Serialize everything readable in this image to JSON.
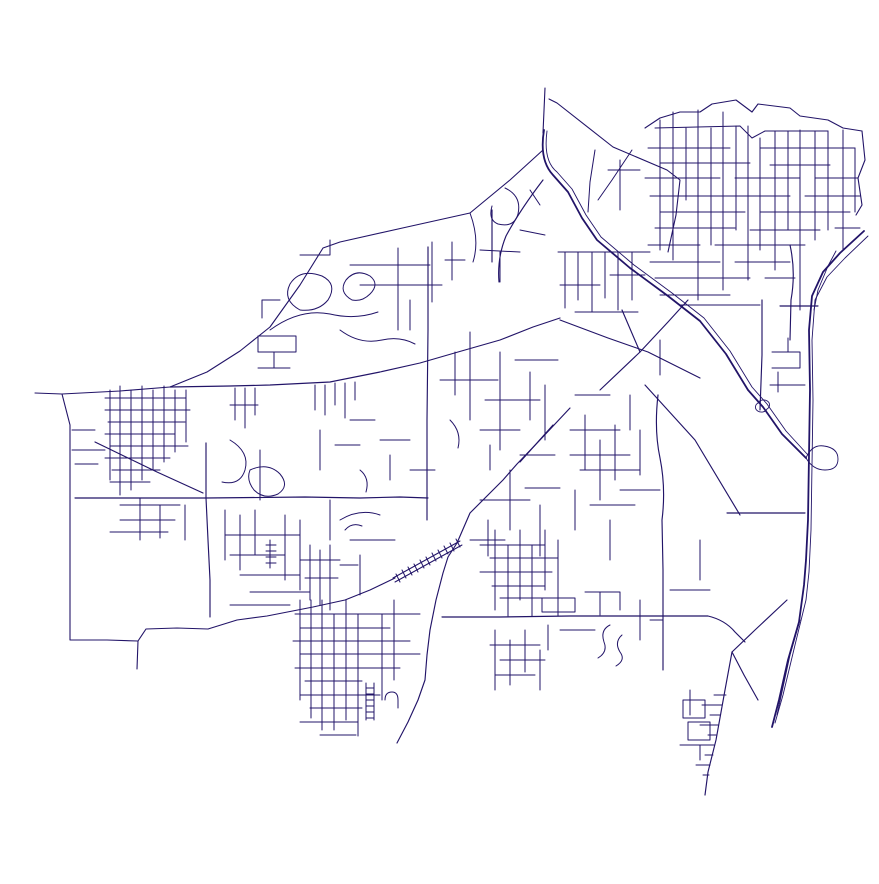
{
  "meta": {
    "description": "street-network-map",
    "background_color": "#ffffff",
    "stroke_color": "#221468",
    "canvas_width": 879,
    "canvas_height": 884
  },
  "map": {
    "stroke_color": "#221468",
    "layers": [
      {
        "name": "boundary",
        "width": 1.1,
        "paths": [
          "M545,88 L543,133",
          "M543,150 L510,180 L470,213 L407,227 L340,242 L323,248 L300,285 L270,327 L240,351 L207,372 L170,387 L120,391 L62,394 L35,393",
          "M62,394 L70,425 L70,555 L70,640 L107,640 L138,641 L146,629 L177,628 L208,629 L237,620 L267,616 L313,607 L345,600 L370,590 L395,578",
          "M138,641 L137,669",
          "M549,99 L557,103 L613,147 L667,170 L680,180 L676,215 L668,252",
          "M645,128 L660,118 L680,112 L700,112 L712,104 L736,100 L752,112 L758,104 L790,108 L800,116 L828,120 L843,128 L862,131",
          "M862,131 L865,160 L858,178 L862,205 L856,215"
        ]
      },
      {
        "name": "highway",
        "width": 1.8,
        "paths": [
          "M544,130 Q539,160 553,175 L568,192 L582,218 L597,240 L630,268 L668,296 L700,321 L726,354 L748,390 L763,407 L782,434 L806,458",
          "M864,231 L840,253 L823,272 L812,296 L809,330 L810,390 L809,455 L808,520 L806,560 L804,585 L799,622 L788,660 L779,700 L772,727"
        ]
      },
      {
        "name": "highway-strands",
        "width": 0.9,
        "paths": [
          "M547,131 Q543,161 557,172 L572,189 L586,215 L601,237 L634,265 L672,293 L704,318 L730,351 L752,387 L767,404 L786,431 L808,455",
          "M868,236 L845,258 L827,277 L815,300 L812,340 L813,400 L812,465 L811,530 L809,572 L806,600 L795,645 L783,695 L775,723",
          "M836,251 L828,266 L818,290 L814,310",
          "M800,620 L790,655 L777,715",
          "M758,403 a6,5 0 1 1 9,6 a6,5 0 1 1 -9,-6",
          "M806,458 q6,-14 18,-12 q14,2 14,13 q0,11 -13,11 q-12,0 -19,-12"
        ]
      },
      {
        "name": "arterial",
        "width": 1.15,
        "paths": [
          "M170,387 L230,386 L270,385 L330,382 L380,372 L420,363 L458,352 L500,340 L533,327 L560,318",
          "M75,498 L150,498 L206,498 L305,497 L360,498 L400,497 L428,498",
          "M428,247 L428,330 L427,420 L427,498 L427,520",
          "M570,408 L540,440 L517,464 L503,480 L470,513 L457,543 L448,557 L443,573 L436,600 L430,630 L427,655 L425,680 L418,700 L408,722 L397,743",
          "M206,443 L206,498 L208,540 L210,580 L210,617",
          "M442,617 L500,617 L570,616 L650,616 L708,616 Q725,620 735,632 L745,642",
          "M95,442 L157,472 L203,493",
          "M560,320 L608,338 L648,352 L700,378",
          "M600,390 L640,352 L668,322 L688,300",
          "M640,352 L622,310",
          "M645,385 L695,440 L740,515",
          "M727,513 L805,513",
          "M658,395 Q654,430 660,458 Q666,488 662,520 L663,570 L663,617 L663,670",
          "M762,300 L762,355 L760,410",
          "M787,600 L755,630 L732,652 L744,675 L758,700",
          "M732,652 L725,690 L716,740 L708,772 L705,795",
          "M492,210 L492,262",
          "M543,180 Q520,210 506,236 Q497,258 499,282",
          "M790,245 Q796,272 791,300 L790,340",
          "M780,306 L818,306",
          "M553,425 L520,462"
        ]
      },
      {
        "name": "railroad",
        "width": 1.0,
        "paths": [
          "M393,578 L460,541",
          "M395,582 L462,545",
          "M396,574 L400,582",
          "M402,570 L406,578",
          "M408,567 L412,575",
          "M414,564 L418,572",
          "M420,560 L424,568",
          "M426,557 L430,565",
          "M432,553 L436,561",
          "M438,550 L442,558",
          "M444,546 L448,554",
          "M450,543 L454,551",
          "M456,539 L460,547"
        ]
      },
      {
        "name": "streets",
        "width": 1.0,
        "paths": [
          "M655,128 L740,126 L752,138 L765,131 L828,131",
          "M648,148 L730,148",
          "M760,148 L855,148",
          "M660,163 L750,163",
          "M770,165 L830,165",
          "M645,178 L720,178",
          "M735,178 L800,178",
          "M815,178 L858,178",
          "M650,196 L790,196",
          "M805,196 L860,196",
          "M660,212 L745,212",
          "M760,212 L850,212",
          "M655,228 L735,228",
          "M750,230 L820,230",
          "M835,228 L860,228",
          "M648,245 L700,245",
          "M715,245 L805,245",
          "M650,262 L720,262",
          "M735,262 L790,262",
          "M655,278 L750,278",
          "M765,278 L795,278",
          "M660,295 L730,295",
          "M680,305 L760,305",
          "M660,120 L660,250",
          "M673,112 L673,260",
          "M686,128 L686,200",
          "M698,110 L698,300",
          "M711,128 L711,245",
          "M723,112 L723,290",
          "M736,126 L736,230",
          "M748,126 L748,280",
          "M760,138 L760,250",
          "M775,131 L775,270",
          "M788,131 L788,230",
          "M800,130 L800,310",
          "M815,131 L815,240",
          "M828,131 L828,230",
          "M843,130 L843,250",
          "M855,148 L855,212",
          "M558,252 L650,252",
          "M565,252 L565,308",
          "M578,252 L578,300",
          "M592,252 L592,312",
          "M605,252 L605,298",
          "M618,252 L618,310",
          "M632,252 L632,300",
          "M560,285 L600,285",
          "M610,275 L645,275",
          "M575,312 L638,312",
          "M595,150 L590,182 L588,212",
          "M632,150 L612,180 L598,200",
          "M620,160 L620,210",
          "M608,170 L640,170",
          "M470,213 Q480,240 473,262",
          "M505,188 Q522,196 518,214 Q514,228 498,224 Q488,220 492,206",
          "M530,190 L540,205",
          "M480,250 L520,252",
          "M500,252 L500,282",
          "M520,230 L545,235",
          "M398,248 L398,330",
          "M432,242 L432,302",
          "M350,265 L430,265",
          "M360,285 L442,285",
          "M300,310 Q282,300 290,284 Q300,268 322,276 Q338,284 328,300 Q318,312 300,310 Z",
          "M352,300 Q338,292 346,280 Q356,268 370,276 Q380,284 370,294 Q362,302 352,300 Z",
          "M270,330 Q300,308 330,314 Q355,320 378,312",
          "M410,300 L410,330",
          "M445,260 L465,260",
          "M452,242 L452,280",
          "M300,255 L330,255 L330,240",
          "M280,300 L262,300 L262,318",
          "M258,352 L296,352 L296,336 L258,336 Z",
          "M258,368 L290,368",
          "M274,368 L274,352",
          "M340,330 Q360,345 382,340 Q400,336 415,344",
          "M470,332 L470,420",
          "M500,352 L500,450",
          "M455,352 L455,395",
          "M440,380 L498,380",
          "M485,400 L540,400",
          "M515,360 L558,360",
          "M530,372 L530,420",
          "M545,385 L545,440",
          "M450,420 Q462,432 458,448",
          "M480,430 L520,430",
          "M490,445 L490,470",
          "M520,455 L555,455",
          "M480,500 L530,500",
          "M510,470 L510,530",
          "M525,488 L560,488",
          "M540,505 L540,556",
          "M470,540 L505,540",
          "M488,520 L488,556",
          "M495,530 L495,610",
          "M508,545 L508,616",
          "M520,530 L520,600",
          "M532,545 L532,616",
          "M545,530 L545,590",
          "M558,540 L558,616",
          "M480,545 L545,545",
          "M490,558 L558,558",
          "M480,572 L552,572",
          "M492,586 L545,586",
          "M500,598 L560,598",
          "M495,630 L495,690",
          "M510,640 L510,685",
          "M525,630 L525,672",
          "M540,650 L540,690",
          "M490,645 L540,645",
          "M500,660 L545,660",
          "M495,675 L535,675",
          "M300,600 L300,700",
          "M311,600 L311,718",
          "M322,600 L322,730",
          "M334,614 L334,730",
          "M346,600 L346,720",
          "M358,614 L358,736",
          "M382,614 L382,700",
          "M394,600 L394,680",
          "M295,614 L420,614",
          "M300,628 L390,628",
          "M293,641 L410,641",
          "M300,654 L420,654",
          "M295,668 L400,668",
          "M305,681 L362,681",
          "M300,695 L380,695",
          "M310,708 L362,708",
          "M300,722 L358,722",
          "M320,735 L356,735",
          "M366,683 L366,720",
          "M374,683 L374,720",
          "M366,688 L374,688",
          "M366,694 L374,694",
          "M366,700 L374,700",
          "M366,706 L374,706",
          "M366,712 L374,712",
          "M366,718 L374,718",
          "M385,700 Q385,692 392,692 Q398,692 398,700 L398,708",
          "M110,390 L110,480",
          "M120,386 L120,495",
          "M131,390 L131,490",
          "M142,386 L142,480",
          "M153,390 L153,470",
          "M164,386 L164,462",
          "M175,390 L175,452",
          "M186,390 L186,442",
          "M105,398 L186,398",
          "M105,410 L190,410",
          "M108,422 L185,422",
          "M105,434 L175,434",
          "M110,446 L188,446",
          "M105,458 L170,458",
          "M112,470 L160,470",
          "M110,482 L150,482",
          "M72,450 L105,450",
          "M75,464 L98,464",
          "M72,430 L95,430",
          "M120,505 L180,505",
          "M140,498 L140,540",
          "M160,505 L160,538",
          "M120,520 L175,520",
          "M110,532 L168,532",
          "M185,505 L185,540",
          "M230,440 Q250,452 245,470 Q240,486 222,482",
          "M260,450 L260,500",
          "M225,510 L225,560",
          "M240,515 L240,570",
          "M255,510 L255,555",
          "M270,540 L270,568",
          "M266,545 L276,545",
          "M266,551 L276,551",
          "M266,557 L276,557",
          "M266,563 L276,563",
          "M285,515 L285,580",
          "M300,520 L300,590",
          "M225,535 L300,535",
          "M230,555 L285,555",
          "M240,575 L300,575",
          "M250,592 L310,592",
          "M230,605 L290,605",
          "M250,470 Q268,462 280,474 Q290,486 278,494 Q264,500 254,490 Q246,480 250,470 Z",
          "M310,545 L310,600",
          "M320,550 L320,605",
          "M330,545 L330,610",
          "M300,560 L340,560",
          "M305,578 L338,578",
          "M340,520 Q360,508 380,515",
          "M350,540 L395,540",
          "M360,555 L360,595",
          "M340,565 L358,565",
          "M345,530 Q352,522 362,526",
          "M330,500 L330,540",
          "M570,430 L620,430",
          "M585,415 L585,470",
          "M600,440 L600,500",
          "M615,425 L615,480",
          "M570,455 L630,455",
          "M580,470 L640,470",
          "M620,490 L660,490",
          "M575,490 L575,530",
          "M590,505 L635,505",
          "M610,520 L610,560",
          "M640,430 L640,475",
          "M630,395 L630,430",
          "M575,395 L610,395",
          "M542,598 L575,598 L575,612 L542,612 Z",
          "M585,592 L620,592 L620,610",
          "M600,592 L600,615",
          "M548,625 L548,650",
          "M560,630 L595,630",
          "M610,625 Q600,630 604,642 Q608,652 598,658",
          "M622,635 Q614,642 620,652 Q626,660 616,666",
          "M640,600 L640,640",
          "M650,620 L663,620",
          "M700,540 L700,580",
          "M670,590 L710,590",
          "M714,695 L726,695",
          "M702,705 L722,705",
          "M710,715 L720,715",
          "M700,725 L718,725",
          "M708,735 L716,735",
          "M698,745 L714,745",
          "M705,755 L713,755",
          "M696,765 L710,765",
          "M703,775 L709,775",
          "M683,700 L705,700 L705,718 L683,718 Z",
          "M688,722 L710,722 L710,740 L688,740 Z",
          "M680,745 L700,745 L700,760",
          "M690,690 L690,715",
          "M772,352 L800,352 L800,368 L772,368",
          "M778,372 L778,392",
          "M770,385 L805,385",
          "M788,352 L788,338",
          "M660,340 L660,375",
          "M380,440 L410,440",
          "M390,455 L390,480",
          "M360,470 Q370,478 366,492",
          "M410,470 L435,470",
          "M320,430 L320,470",
          "M335,445 L360,445",
          "M350,420 L375,420",
          "M315,385 L315,410",
          "M325,385 L325,415",
          "M335,383 L335,405",
          "M345,383 L345,418",
          "M355,382 L355,400",
          "M235,388 L235,420",
          "M245,388 L245,428",
          "M255,388 L255,415",
          "M230,405 L258,405"
        ]
      }
    ]
  }
}
